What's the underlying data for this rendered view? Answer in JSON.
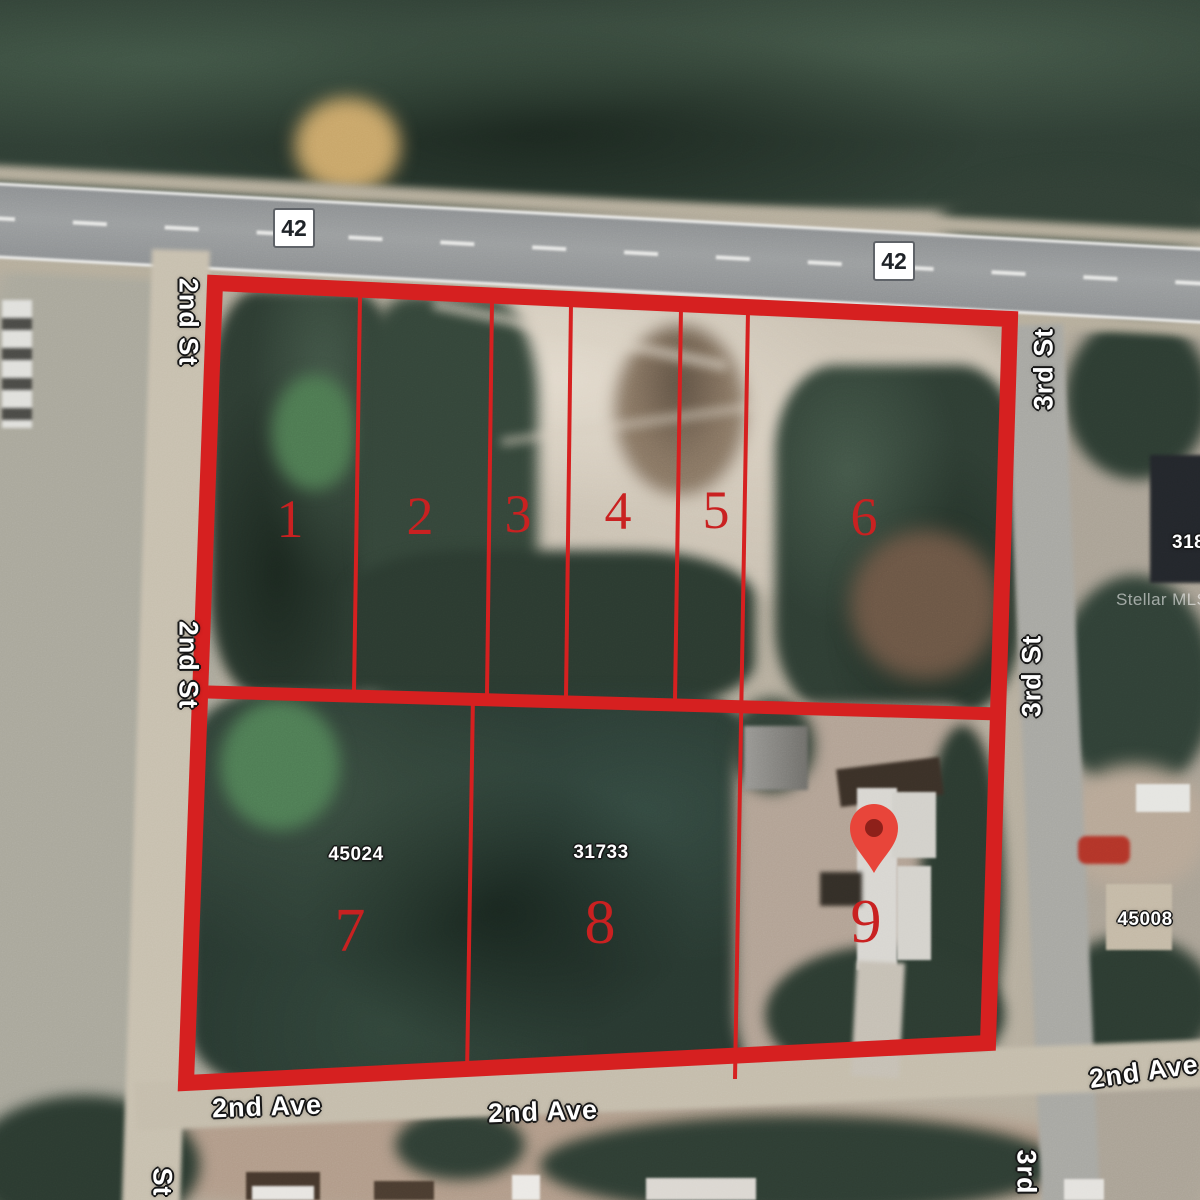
{
  "theme": {
    "boundary-red": "#d62020",
    "lot-number-red": "#c92121",
    "pin-red": "#e8453a",
    "pin-core": "#8e201a",
    "label-white": "#ffffff",
    "label-outline": "#161616"
  },
  "map": {
    "highway_badges": [
      {
        "label": "42"
      },
      {
        "label": "42"
      }
    ],
    "street_labels": {
      "second_st_top": "2nd St",
      "second_st_mid": "2nd St",
      "third_st_top": "3rd St",
      "third_st_mid": "3rd St",
      "st_partial_bottom_left": "St",
      "third_partial_bottom_right": "3rd",
      "second_ave_left": "2nd Ave",
      "second_ave_mid": "2nd Ave",
      "second_ave_right": "2nd Ave"
    },
    "lot_numbers": [
      "1",
      "2",
      "3",
      "4",
      "5",
      "6",
      "7",
      "8",
      "9"
    ],
    "parcel_numbers": {
      "lot7": "45024",
      "lot8": "31733",
      "right_building": "45008",
      "right_edge_partial": "318"
    },
    "watermark": "Stellar MLS"
  }
}
